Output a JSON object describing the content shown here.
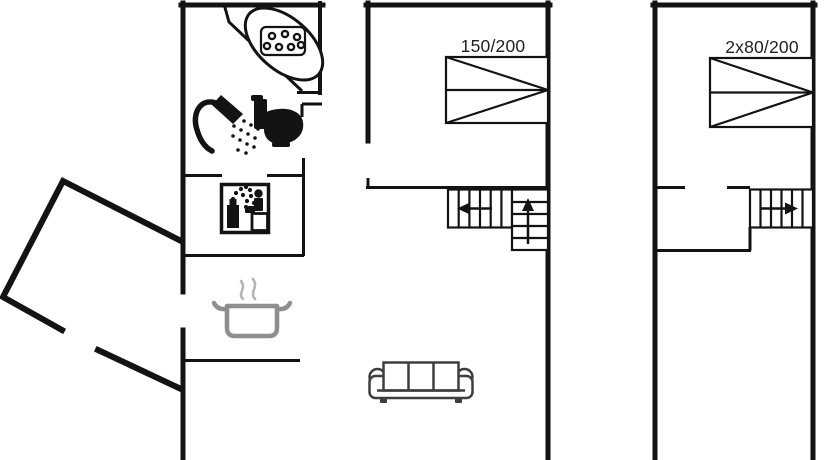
{
  "canvas": {
    "width": 834,
    "height": 460,
    "background": "#ffffff"
  },
  "colors": {
    "wall": "#131313",
    "icon": "#131313",
    "pot": "#8e8e8e",
    "steam": "#b4b4b4",
    "sofa": "#3e3e3e",
    "text": "#1f1f1f"
  },
  "beds": {
    "double": {
      "label": "150/200"
    },
    "twin": {
      "label": "2x80/200"
    }
  },
  "icons": {
    "bathtub": "whirlpool-bathtub",
    "shower": "handheld-shower",
    "toilet": "toilet",
    "sauna": "sauna-with-person",
    "pot": "cooking-pot-with-steam",
    "sofa": "three-seat-sofa",
    "stairs_middle_upper": "arrow-left",
    "stairs_middle_lower": "arrow-up",
    "stairs_right": "arrow-right"
  }
}
